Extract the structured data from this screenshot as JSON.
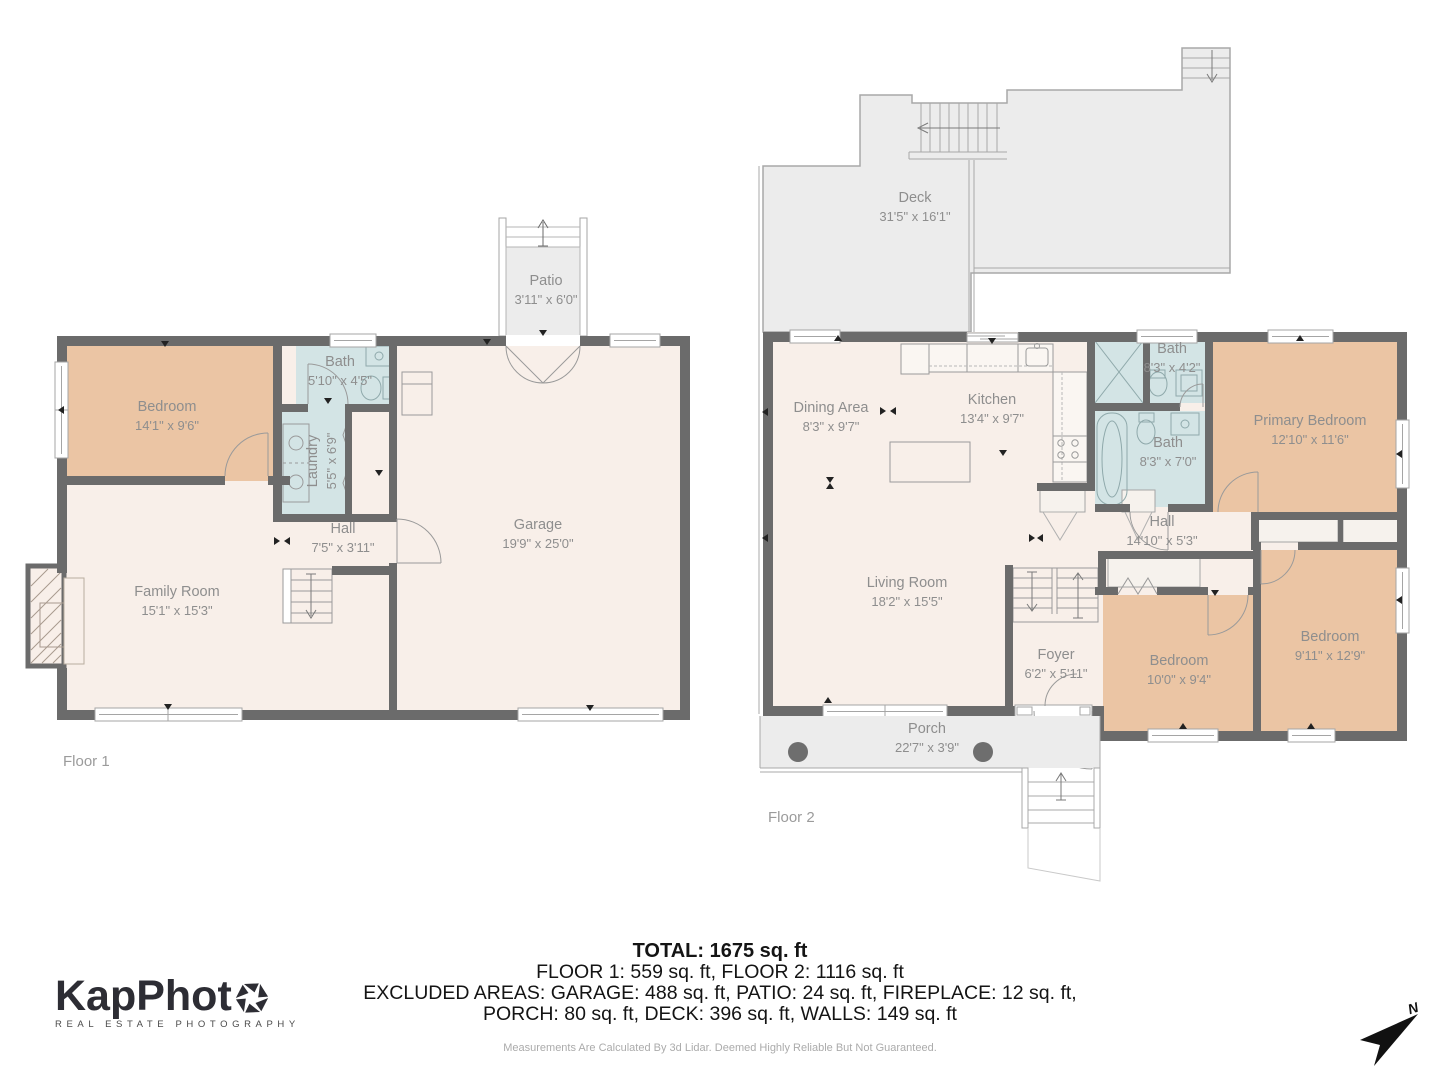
{
  "floor1": {
    "label": "Floor 1",
    "rooms": {
      "bedroom": {
        "name": "Bedroom",
        "dims": "14'1\" x 9'6\""
      },
      "bath": {
        "name": "Bath",
        "dims": "5'10\" x 4'5\""
      },
      "laundry": {
        "name": "Laundry",
        "dims": "5'5\" x 6'9\""
      },
      "hall": {
        "name": "Hall",
        "dims": "7'5\" x 3'11\""
      },
      "family": {
        "name": "Family Room",
        "dims": "15'1\" x 15'3\""
      },
      "garage": {
        "name": "Garage",
        "dims": "19'9\" x 25'0\""
      },
      "patio": {
        "name": "Patio",
        "dims": "3'11\" x 6'0\""
      }
    }
  },
  "floor2": {
    "label": "Floor 2",
    "rooms": {
      "deck": {
        "name": "Deck",
        "dims": "31'5\" x 16'1\""
      },
      "dining": {
        "name": "Dining Area",
        "dims": "8'3\" x 9'7\""
      },
      "kitchen": {
        "name": "Kitchen",
        "dims": "13'4\" x 9'7\""
      },
      "bath_upper": {
        "name": "Bath",
        "dims": "8'3\" x 4'2\""
      },
      "bath_lower": {
        "name": "Bath",
        "dims": "8'3\" x 7'0\""
      },
      "primary": {
        "name": "Primary Bedroom",
        "dims": "12'10\" x 11'6\""
      },
      "hall": {
        "name": "Hall",
        "dims": "14'10\" x 5'3\""
      },
      "living": {
        "name": "Living Room",
        "dims": "18'2\" x 15'5\""
      },
      "foyer": {
        "name": "Foyer",
        "dims": "6'2\" x 5'11\""
      },
      "bedroom_left": {
        "name": "Bedroom",
        "dims": "10'0\" x 9'4\""
      },
      "bedroom_right": {
        "name": "Bedroom",
        "dims": "9'11\" x 12'9\""
      },
      "porch": {
        "name": "Porch",
        "dims": "22'7\" x 3'9\""
      }
    }
  },
  "summary": {
    "total": "TOTAL: 1675 sq. ft",
    "floors_line": "FLOOR 1: 559 sq. ft, FLOOR 2: 1116 sq. ft",
    "excluded_line1": "EXCLUDED AREAS: GARAGE: 488 sq. ft, PATIO: 24 sq. ft, FIREPLACE: 12 sq. ft,",
    "excluded_line2": "PORCH: 80 sq. ft, DECK: 396 sq. ft, WALLS: 149 sq. ft",
    "disclaimer": "Measurements Are Calculated By 3d Lidar. Deemed Highly Reliable But Not Guaranteed."
  },
  "logo": {
    "wordmark": "KapPhot",
    "tagline": "REAL ESTATE PHOTOGRAPHY"
  },
  "compass": {
    "label": "N"
  },
  "colors": {
    "wall": "#6b6b6b",
    "floor": "#f8efe9",
    "bedroom": "#ebc5a4",
    "bath": "#d3e4e5",
    "outdoor": "#ececec",
    "label_text": "#8e8e8e",
    "summary_text": "#141414"
  }
}
